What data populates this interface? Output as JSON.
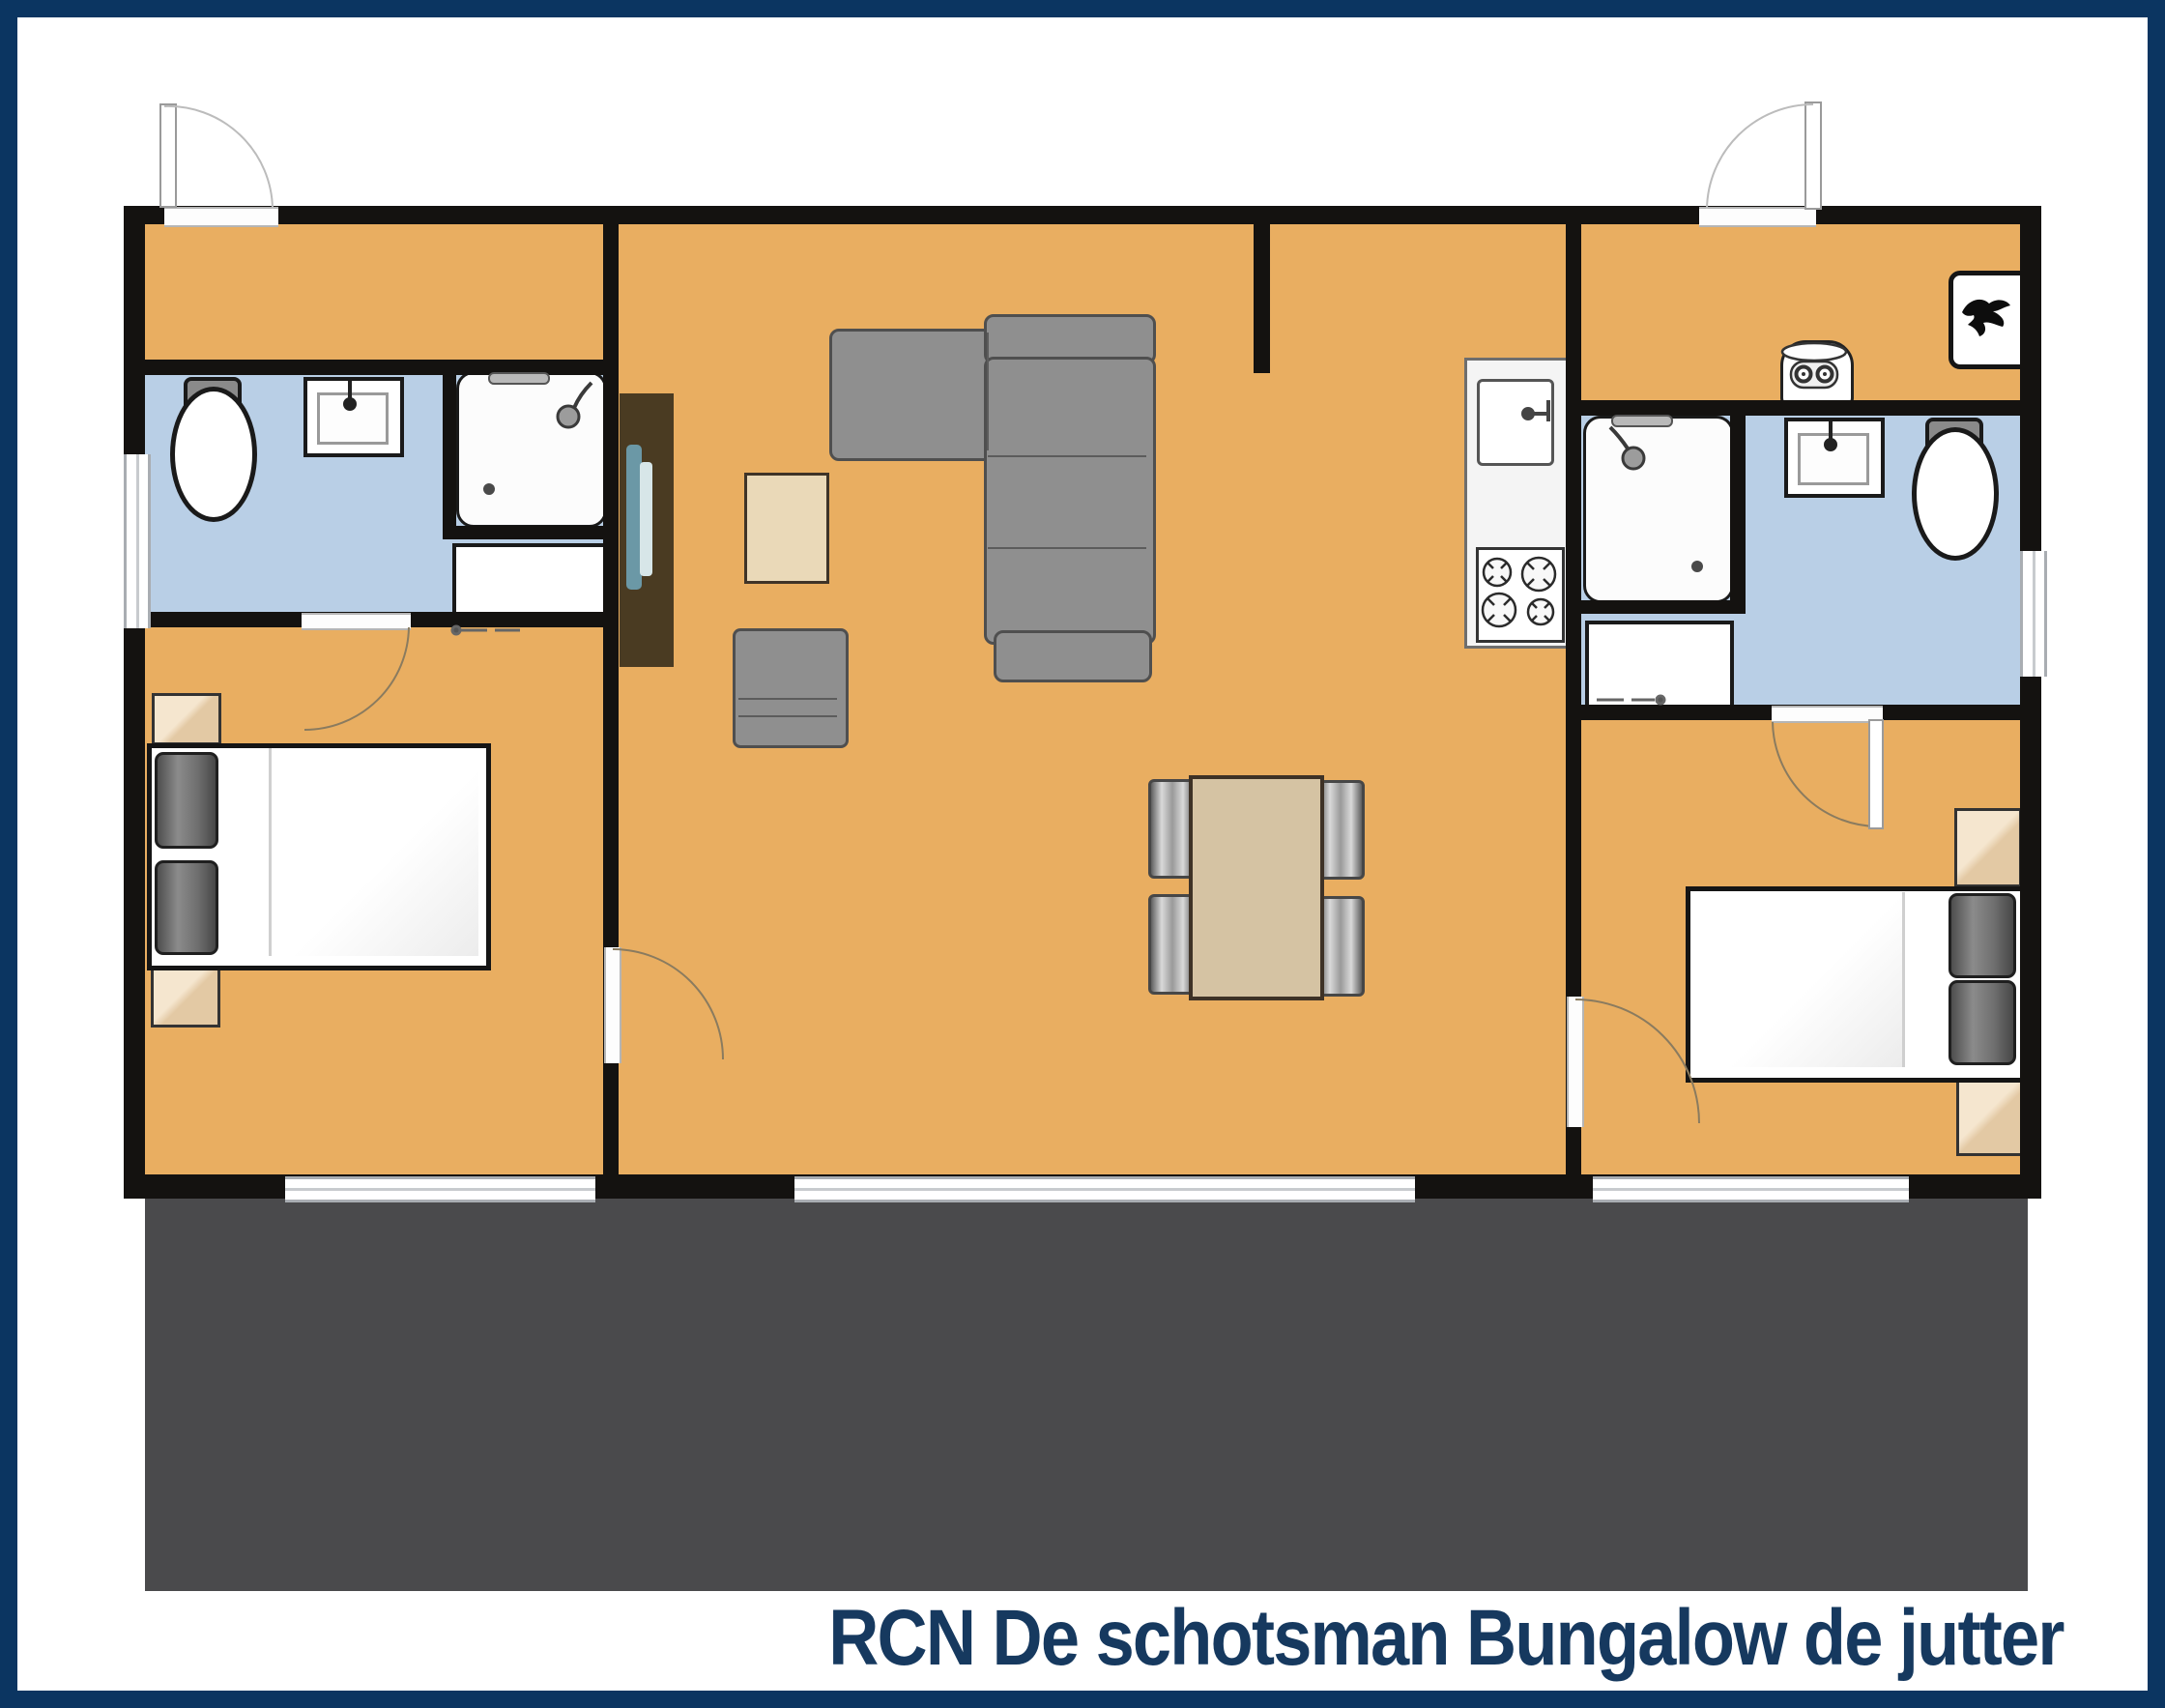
{
  "title": {
    "text": "RCN De schotsman Bungalow de jutter"
  },
  "colors": {
    "navy": "#0b3561",
    "title-color": "#16395f",
    "floor": "#e9ae61",
    "bath": "#b9cfe6",
    "wall": "#141210",
    "terrace": "#4a4a4c",
    "wood": "#d5c3a3",
    "coffee": "#ead9b8",
    "cabinet": "#4a3b22",
    "tv": "#6b98a6",
    "sofa": "#8f8f8f",
    "tan": "#e8d0ae"
  },
  "areas": [
    "left-entry-hall",
    "left-bathroom",
    "left-bedroom",
    "living-room",
    "kitchen",
    "right-entry-hall",
    "right-bathroom",
    "right-bedroom",
    "terrace"
  ],
  "icons": [
    "entry-door-icon",
    "door-swing-icon",
    "window-icon",
    "toilet-icon",
    "sink-icon",
    "shower-icon",
    "washing-machine-icon",
    "boiler-icon",
    "coat-hooks-icon",
    "tv-cabinet-icon",
    "tv-icon",
    "corner-sofa-icon",
    "armchair-icon",
    "coffee-table-icon",
    "dining-table-icon",
    "dining-chair-icon",
    "kitchen-counter-icon",
    "kitchen-sink-icon",
    "stove-icon",
    "double-bed-icon",
    "pillow-icon",
    "nightstand-icon",
    "terrace-area"
  ]
}
